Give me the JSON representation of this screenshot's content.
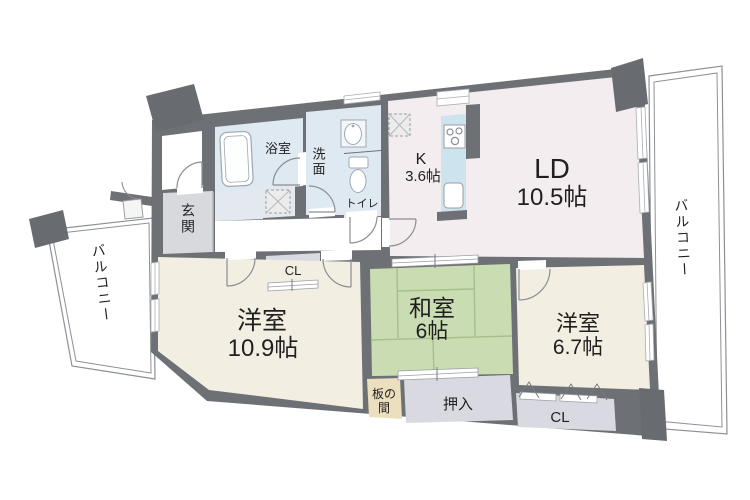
{
  "floorplan": {
    "type": "apartment-madori",
    "labels": {
      "ld_name": "LD",
      "ld_size": "10.5帖",
      "k_name": "K",
      "k_size": "3.6帖",
      "w1_name": "洋室",
      "w1_size": "10.9帖",
      "j_name": "和室",
      "j_size": "6帖",
      "w2_name": "洋室",
      "w2_size": "6.7帖",
      "bath": "浴室",
      "wash": "洗面",
      "toilet": "トイレ",
      "genkan": "玄関",
      "cl_hall": "CL",
      "cl_w2": "CL",
      "oshiire": "押入",
      "itanoma_line1": "板の",
      "itanoma_line2": "間",
      "balcony_left": "バルコニー",
      "balcony_right": "バルコニー"
    },
    "colors": {
      "wall": "#6d7176",
      "pillar": "#686c71",
      "ld_floor": "#f3edf0",
      "western_floor": "#f2efe2",
      "tatami": "#cadcb2",
      "tatami_line": "#a6bf8b",
      "wet_area": "#dfe9f2",
      "kitchen_counter": "#cde3ee",
      "genkan_floor": "#d8d9dd",
      "closet_floor": "#d9dae1",
      "itanoma_floor": "#ecdfc0",
      "hall_nook": "#e4e9ef",
      "balcony_line": "#8d9196",
      "door_arc": "#8a8e93",
      "text": "#1f1f1f"
    }
  }
}
